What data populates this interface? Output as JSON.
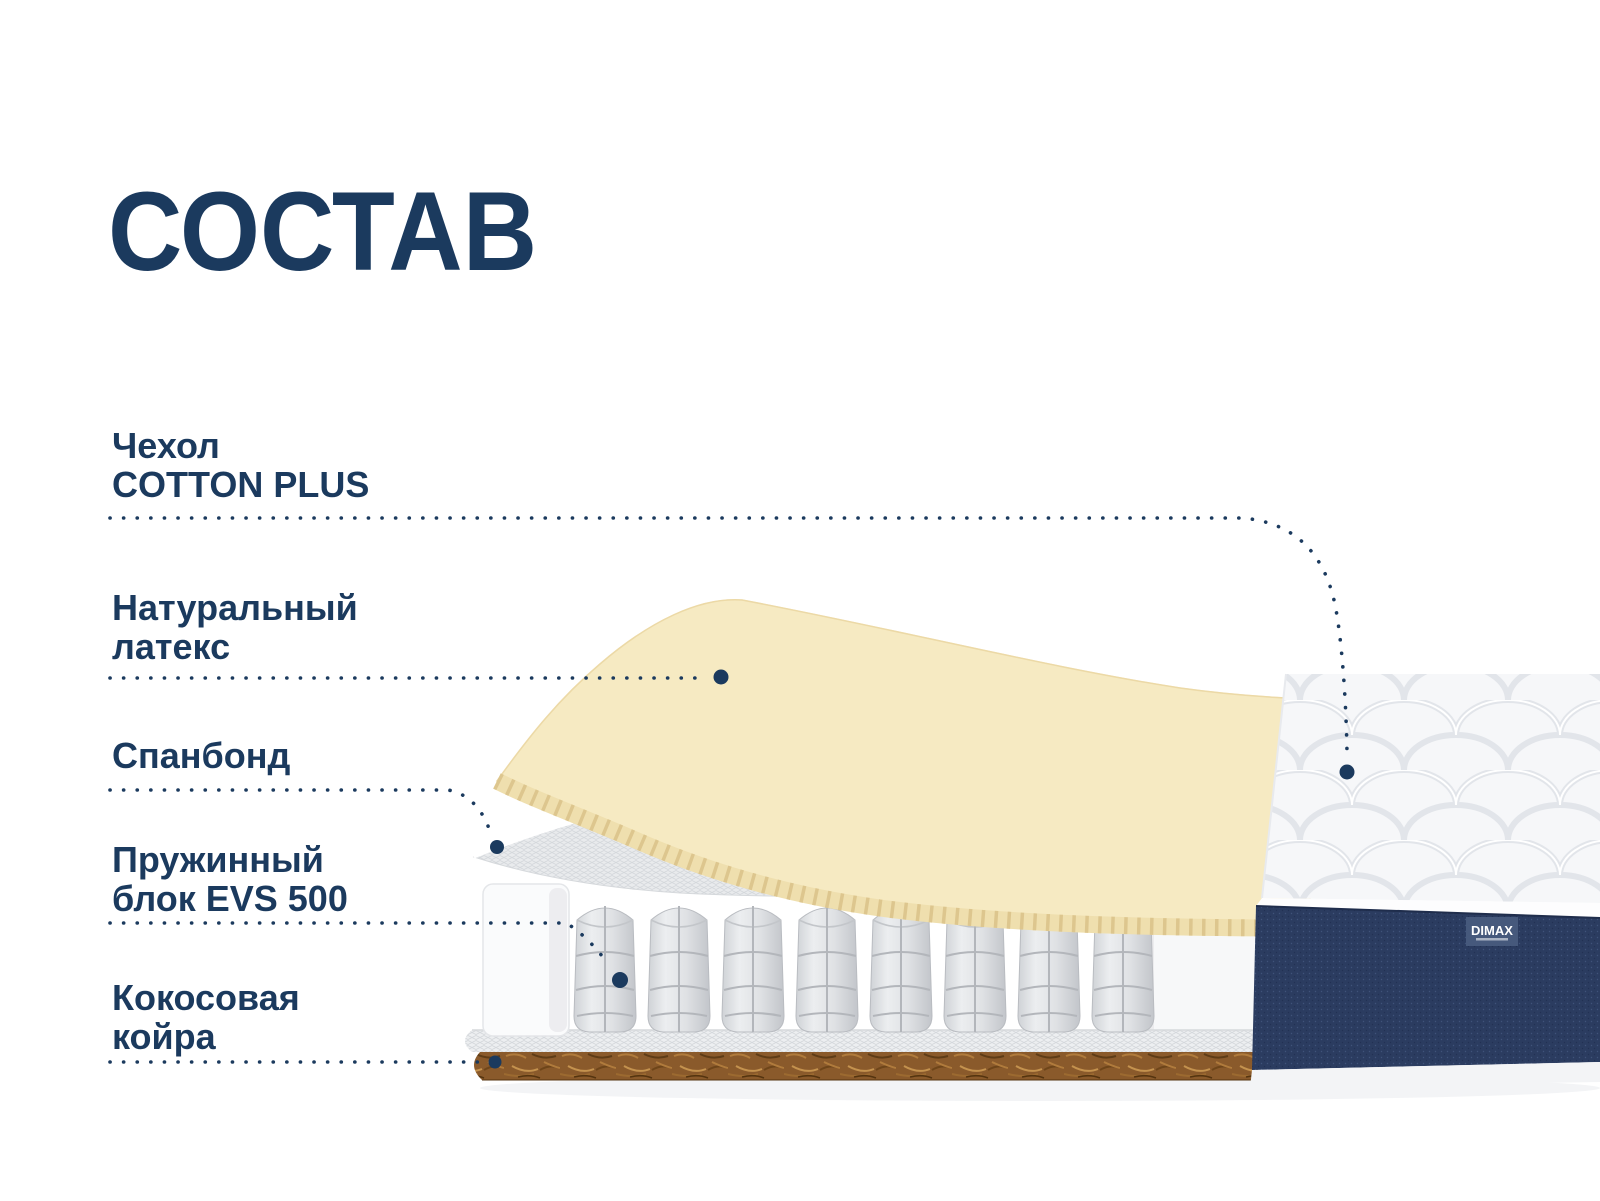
{
  "title": "СОСТАВ",
  "labels": [
    {
      "id": "cover",
      "line1": "Чехол",
      "line2": "COTTON PLUS"
    },
    {
      "id": "latex",
      "line1": "Натуральный",
      "line2": "латекс"
    },
    {
      "id": "spunbond",
      "line1": "Спанбонд",
      "line2": ""
    },
    {
      "id": "springs",
      "line1": "Пружинный",
      "line2": "блок EVS 500"
    },
    {
      "id": "coir",
      "line1": "Кокосовая",
      "line2": "койра"
    }
  ],
  "brand": {
    "name": "DIMAX"
  },
  "colors": {
    "text_navy": "#1b3a5e",
    "latex_cream": "#f6eac2",
    "latex_rib": "#e9d5a0",
    "quilt_bg": "#f6f7f9",
    "quilt_line": "#e2e5ea",
    "navy_fabric": "#2b3c60",
    "brand_label_bg": "#46597c",
    "coir_brown": "#8a5a2b",
    "spring_gray": "#d9dbde",
    "spunbond_gray": "#e9ebed"
  }
}
